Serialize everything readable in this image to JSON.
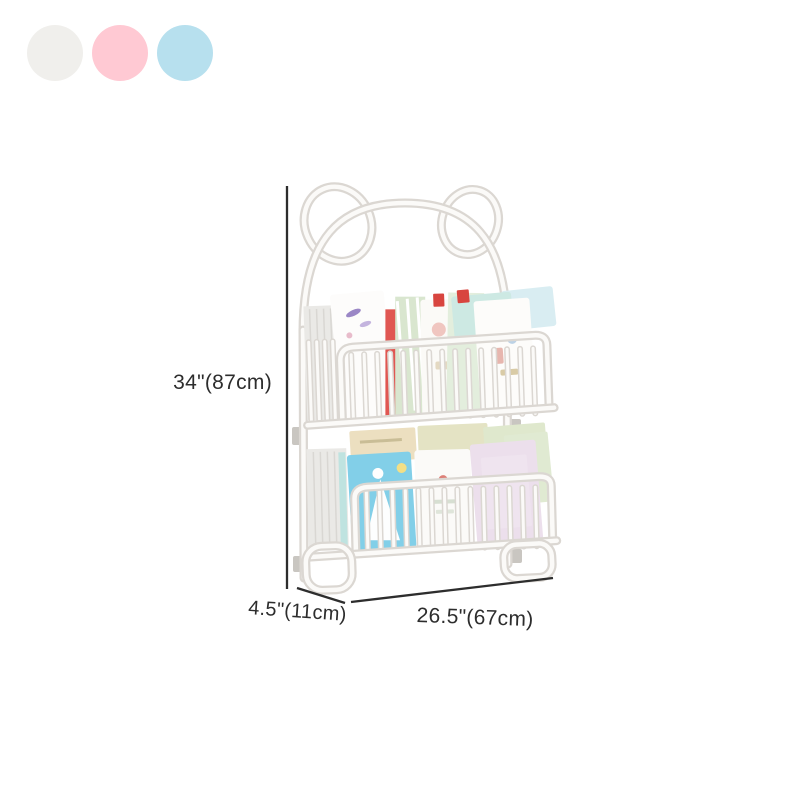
{
  "theme": {
    "bg": "#ffffff",
    "frame_edge": "#dbd7d2",
    "frame_face": "#fbfaf8",
    "bracket": "#c9c6c1",
    "dim_line": "#2d2d2d",
    "label_color": "#2d2d2d"
  },
  "swatches": {
    "items": [
      {
        "name": "white",
        "color": "#f0efec"
      },
      {
        "name": "pink",
        "color": "#ffc9d3"
      },
      {
        "name": "blue",
        "color": "#b7e0ee"
      }
    ]
  },
  "dimensions": {
    "height_label": "34\"(87cm)",
    "depth_label": "4.5\"(11cm)",
    "width_label": "26.5\"(67cm)"
  },
  "product": {
    "type": "two-tier bear-ear wall-mounted kids book rack, white frame, filled with picture books",
    "upper_books": [
      {
        "name": "white-spines-stack",
        "color": "#eae9e6"
      },
      {
        "name": "airplane-book",
        "color": "#fdfcfb"
      },
      {
        "name": "red-book",
        "color": "#e05752"
      },
      {
        "name": "green-striped-book",
        "color": "#d9e6cf"
      },
      {
        "name": "pale-white-book",
        "color": "#fbfaf7"
      },
      {
        "name": "mint-book",
        "color": "#e3eedd"
      },
      {
        "name": "illustrated-book",
        "color": "#fdfcfa"
      },
      {
        "name": "teal-book",
        "color": "#cde9e3"
      },
      {
        "name": "pale-blue-book",
        "color": "#d9edf2"
      }
    ],
    "lower_books": [
      {
        "name": "white-spines-stack",
        "color": "#eae9e6"
      },
      {
        "name": "blue-dress-book",
        "color": "#82cfe8"
      },
      {
        "name": "white-book",
        "color": "#fbfaf8"
      },
      {
        "name": "lavender-book",
        "color": "#ecdfec"
      },
      {
        "name": "pale-green-book",
        "color": "#e0ead2"
      }
    ],
    "back_books": [
      {
        "name": "tan-book",
        "color": "#ecdfc0"
      },
      {
        "name": "olive-book",
        "color": "#e4e3c4"
      },
      {
        "name": "sage-book",
        "color": "#dfe8cd"
      }
    ]
  }
}
